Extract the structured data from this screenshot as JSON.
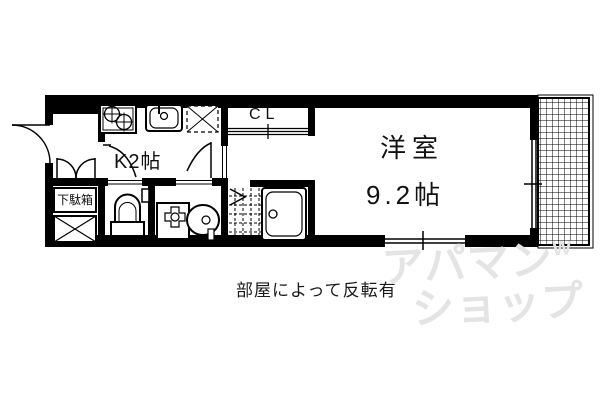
{
  "floorplan": {
    "rooms": {
      "western_room": {
        "name": "洋室",
        "size": "9.2帖"
      },
      "kitchen": {
        "label": "K2帖"
      },
      "closet": {
        "label": "CL"
      },
      "shoe_cabinet": {
        "label": "下駄箱"
      }
    },
    "caption": "部屋によって反転有",
    "watermark": {
      "line1": "アパマン",
      "mark": "W",
      "line2": "ショップ"
    },
    "colors": {
      "line": "#000000",
      "background": "#ffffff",
      "watermark": "#e4e4e4"
    }
  }
}
